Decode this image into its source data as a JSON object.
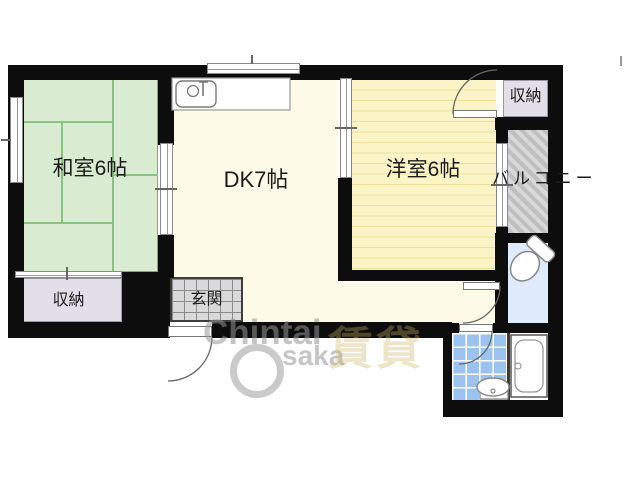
{
  "colors": {
    "wall": "#0d0d0d",
    "tatami": "#d9ecd2",
    "tatami-line": "#8cc184",
    "dk": "#fdfae8",
    "yoshitsu": "#faf4c6",
    "yoshitsu-line": "#ece099",
    "storage": "#e3dfe9",
    "balcony-bg": "#d8d8d8",
    "balcony-line": "#bfbfbf",
    "toilet": "#dfeafa",
    "tile": "#9cc3ef",
    "genkan-bg": "#d9d9d9",
    "genkan-line": "#8a8a8a"
  },
  "rooms": {
    "washitsu": {
      "label": "和室6帖"
    },
    "dk": {
      "label": "DK7帖"
    },
    "yoshitsu": {
      "label": "洋室6帖"
    },
    "storage_top": {
      "label": "収納"
    },
    "storage_bottom": {
      "label": "収納"
    },
    "balcony": {
      "label": "バルコニー"
    },
    "genkan": {
      "label": "玄関"
    }
  },
  "fixtures": {
    "kitchen_sink": "kitchen sink",
    "toilet": "toilet",
    "bathtub": "bathtub",
    "washbasin": "washbasin"
  },
  "watermark": {
    "line1": "Chintai",
    "line2": "saka",
    "cjk": "賃貸"
  }
}
